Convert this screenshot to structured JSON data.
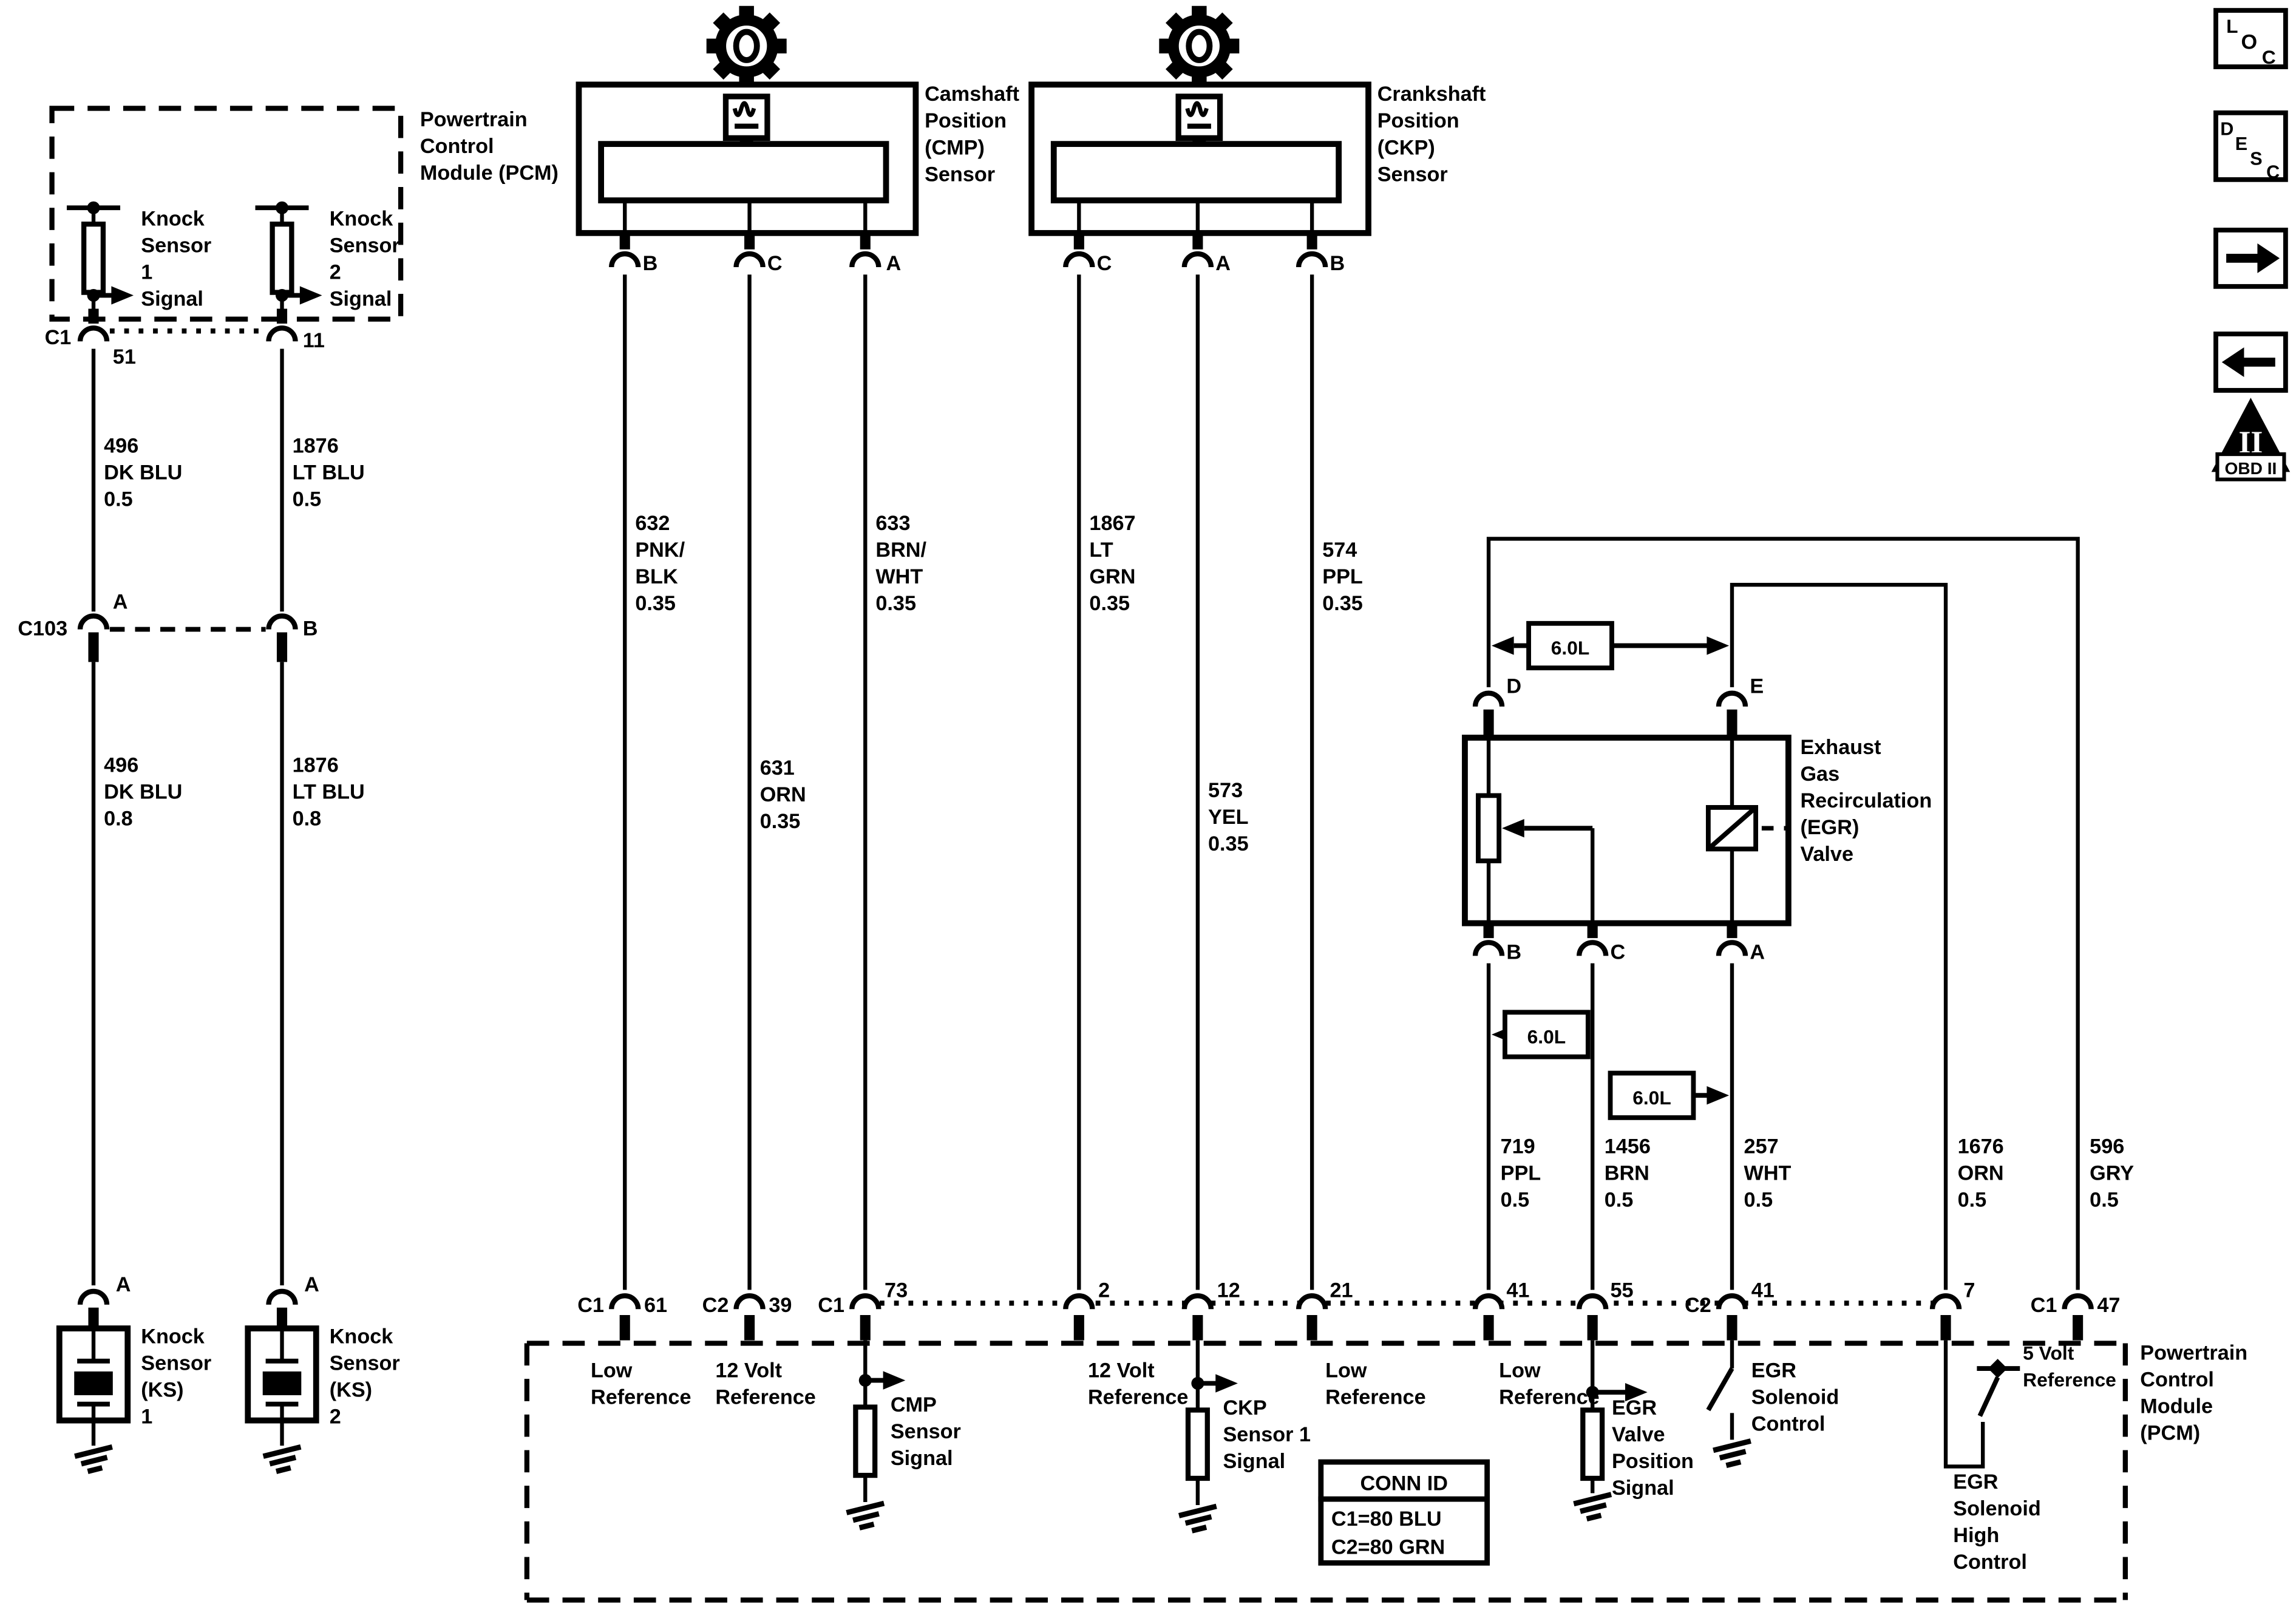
{
  "pcm_top": {
    "label": [
      "Powertrain",
      "Control",
      "Module (PCM)"
    ],
    "connector": "C1",
    "pin_left": "51",
    "pin_right": "11",
    "ks1_signal": [
      "Knock",
      "Sensor",
      "1",
      "Signal"
    ],
    "ks2_signal": [
      "Knock",
      "Sensor",
      "2",
      "Signal"
    ]
  },
  "harness_left": {
    "c103": "C103",
    "pin_a": "A",
    "pin_b": "B",
    "wire_496_upper": [
      "496",
      "DK BLU",
      "0.5"
    ],
    "wire_1876_upper": [
      "1876",
      "LT BLU",
      "0.5"
    ],
    "wire_496_lower": [
      "496",
      "DK BLU",
      "0.8"
    ],
    "wire_1876_lower": [
      "1876",
      "LT BLU",
      "0.8"
    ]
  },
  "ks": {
    "pin_a1": "A",
    "pin_a2": "A",
    "ks1": [
      "Knock",
      "Sensor",
      "(KS)",
      "1"
    ],
    "ks2": [
      "Knock",
      "Sensor",
      "(KS)",
      "2"
    ]
  },
  "cmp": {
    "label": [
      "Camshaft",
      "Position",
      "(CMP)",
      "Sensor"
    ],
    "pin_b": "B",
    "pin_c": "C",
    "pin_a": "A",
    "wire_632": [
      "632",
      "PNK/",
      "BLK",
      "0.35"
    ],
    "wire_631": [
      "631",
      "ORN",
      "0.35"
    ],
    "wire_633": [
      "633",
      "BRN/",
      "WHT",
      "0.35"
    ]
  },
  "ckp": {
    "label": [
      "Crankshaft",
      "Position",
      "(CKP)",
      "Sensor"
    ],
    "pin_c": "C",
    "pin_a": "A",
    "pin_b": "B",
    "wire_1867": [
      "1867",
      "LT",
      "GRN",
      "0.35"
    ],
    "wire_573": [
      "573",
      "YEL",
      "0.35"
    ],
    "wire_574": [
      "574",
      "PPL",
      "0.35"
    ]
  },
  "egr": {
    "label": [
      "Exhaust",
      "Gas",
      "Recirculation",
      "(EGR)",
      "Valve"
    ],
    "pin_d": "D",
    "pin_e": "E",
    "pin_b": "B",
    "pin_c": "C",
    "pin_a": "A",
    "engine_size_1": "6.0L",
    "engine_size_2": "6.0L",
    "engine_size_3": "6.0L",
    "wire_719": [
      "719",
      "PPL",
      "0.5"
    ],
    "wire_1456": [
      "1456",
      "BRN",
      "0.5"
    ],
    "wire_257": [
      "257",
      "WHT",
      "0.5"
    ],
    "wire_1676": [
      "1676",
      "ORN",
      "0.5"
    ],
    "wire_596": [
      "596",
      "GRY",
      "0.5"
    ]
  },
  "pcm_bottom": {
    "label": [
      "Powertrain",
      "Control",
      "Module",
      "(PCM)"
    ],
    "p61": {
      "conn": "C1",
      "pin": "61",
      "fn": [
        "Low",
        "Reference"
      ]
    },
    "p39": {
      "conn": "C2",
      "pin": "39",
      "fn": [
        "12 Volt",
        "Reference"
      ]
    },
    "p73": {
      "conn": "C1",
      "pin": "73",
      "fn": [
        "CMP",
        "Sensor",
        "Signal"
      ]
    },
    "p2": {
      "pin": "2",
      "fn": [
        "12 Volt",
        "Reference"
      ]
    },
    "p12": {
      "pin": "12",
      "fn": [
        "CKP",
        "Sensor 1",
        "Signal"
      ]
    },
    "p21": {
      "pin": "21",
      "fn": [
        "Low",
        "Reference"
      ]
    },
    "p41": {
      "pin": "41",
      "fn": [
        "Low",
        "Reference"
      ]
    },
    "p55": {
      "pin": "55",
      "fn": [
        "EGR",
        "Valve",
        "Position",
        "Signal"
      ]
    },
    "p41c2": {
      "conn": "C2",
      "pin": "41",
      "fn": [
        "EGR",
        "Solenoid",
        "Control"
      ]
    },
    "p7": {
      "pin": "7",
      "fn": [
        "EGR",
        "Solenoid",
        "High",
        "Control"
      ]
    },
    "p47": {
      "conn": "C1",
      "pin": "47",
      "fn": [
        "5 Volt",
        "Reference"
      ]
    },
    "conn_id": {
      "header": "CONN ID",
      "row1": "C1=80 BLU",
      "row2": "C2=80 GRN"
    }
  },
  "margin": {
    "loc": {
      "l": "L",
      "o": "O",
      "c": "C"
    },
    "desc": {
      "d": "D",
      "e": "E",
      "s": "S",
      "c": "C"
    },
    "obd": {
      "numeral": "II",
      "label": "OBD II"
    }
  }
}
